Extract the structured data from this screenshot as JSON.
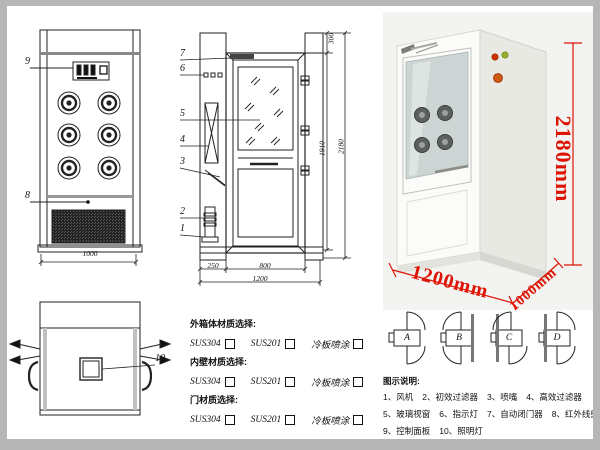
{
  "colors": {
    "dim_red": "#dd1404",
    "line": "#222222"
  },
  "front_view": {
    "callout_9": "9",
    "callout_8": "8",
    "dim_width": "1000"
  },
  "side_view": {
    "callouts": [
      "7",
      "6",
      "5",
      "4",
      "3",
      "2",
      "1"
    ],
    "dim_300": "300",
    "dim_1910": "1910",
    "dim_2180": "2180",
    "dim_250": "250",
    "dim_800": "800",
    "dim_1200": "1200"
  },
  "photo_dims": {
    "height": "2180mm",
    "width": "1200mm",
    "depth": "1000mm"
  },
  "top_view": {
    "callout_10": "10"
  },
  "materials": {
    "sections": [
      {
        "label": "外箱体材质选择:",
        "options": [
          "SUS304",
          "SUS201",
          "冷板喷涂"
        ]
      },
      {
        "label": "内壁材质选择:",
        "options": [
          "SUS304",
          "SUS201",
          "冷板喷涂"
        ]
      },
      {
        "label": "门材质选择:",
        "options": [
          "SUS304",
          "SUS201",
          "冷板喷涂"
        ]
      }
    ]
  },
  "door_configs": {
    "labels": [
      "A",
      "B",
      "C",
      "D"
    ]
  },
  "legend": {
    "title": "图示说明:",
    "items": [
      "1、风机",
      "2、初效过滤器",
      "3、喷嘴",
      "4、高效过滤器",
      "5、玻璃视窗",
      "6、指示灯",
      "7、自动闭门器",
      "8、红外线感应器",
      "9、控制面板",
      "10、照明灯"
    ]
  }
}
